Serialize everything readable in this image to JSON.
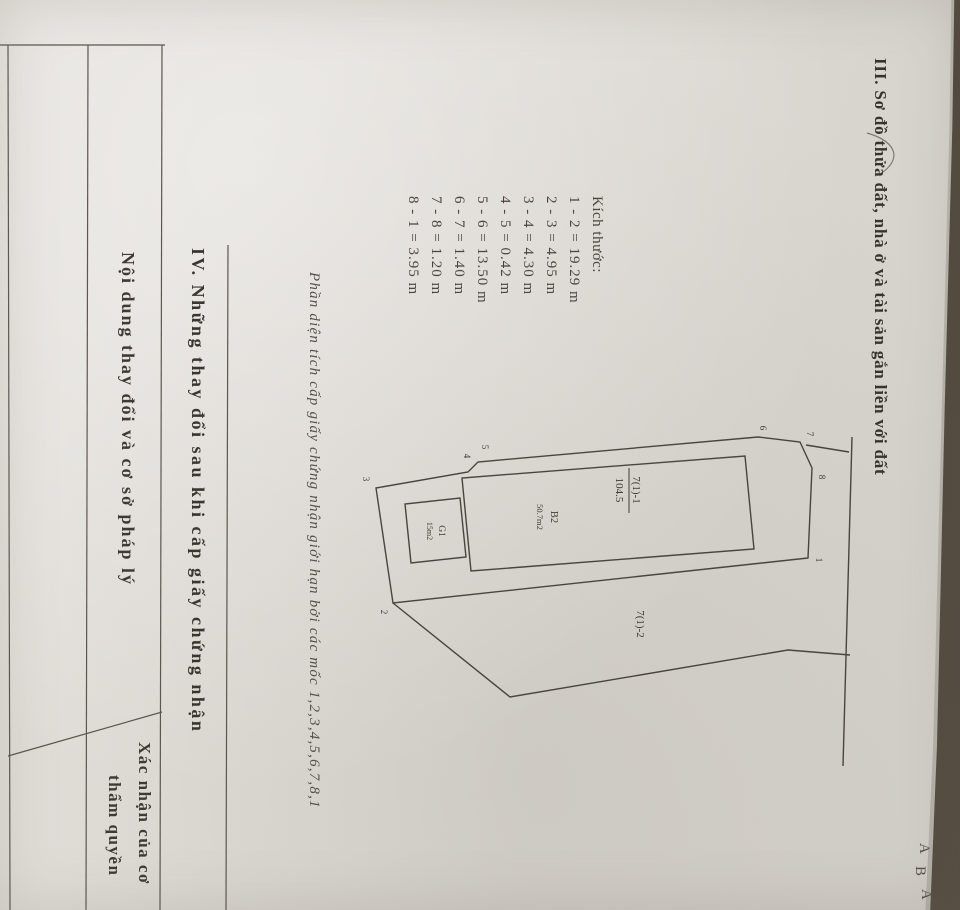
{
  "doc": {
    "section3": {
      "title": "III. Sơ đồ thửa đất, nhà ở và tài sản gắn liền với đất",
      "dimensions": {
        "heading": "Kích thước:",
        "items": [
          "1 - 2 = 19.29 m",
          "2 - 3 = 4.95 m",
          "3 - 4 = 4.30 m",
          "4 - 5 = 0.42 m",
          "5 - 6 = 13.50 m",
          "6 - 7 = 1.40 m",
          "7 - 8 = 1.20 m",
          "8 - 1 = 3.95 m"
        ]
      },
      "note": "Phần diện tích cấp giấy chứng nhận giới hạn bởi các mốc 1,2,3,4,5,6,7,8,1",
      "diagram": {
        "parcel_number": "7(1)-1",
        "parcel_area": "104.5",
        "building_label": "B2",
        "building_area": "50.7m2",
        "structure_label": "G1",
        "structure_area": "15m2",
        "adjacent_parcel": "7(1)-2",
        "vertices": [
          "1",
          "2",
          "3",
          "4",
          "5",
          "6",
          "7",
          "8"
        ]
      },
      "margin_letters": [
        "A",
        "B",
        "A"
      ]
    },
    "section4": {
      "title": "IV. Những thay đổi sau khi cấp giấy chứng nhận",
      "columns": [
        {
          "label": "Nội dung thay đổi và cơ sở pháp lý"
        },
        {
          "lines": [
            "Xác nhận của cơ",
            "thẩm quyền"
          ]
        }
      ]
    }
  },
  "colors": {
    "paper": "#dcd9d3",
    "ink": "#46403a",
    "scan_edge": "#5a5246"
  }
}
